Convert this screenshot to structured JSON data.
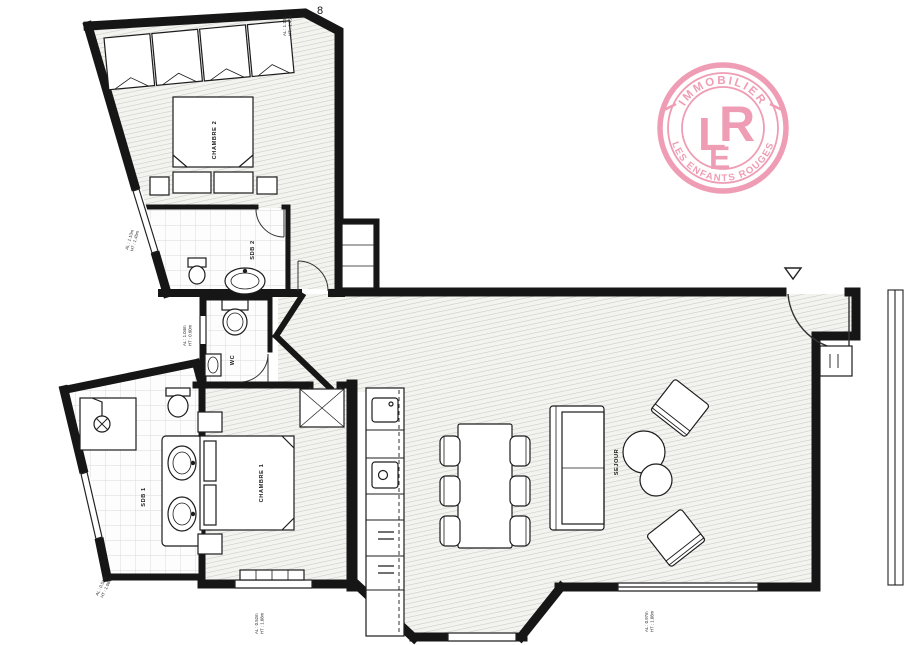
{
  "logo": {
    "arc_top": "IMMOBILIER",
    "arc_bottom": "LES ENFANTS ROUGES",
    "letters": [
      "L",
      "E",
      "R"
    ],
    "color": "#ef9db4"
  },
  "rooms": {
    "bedroom2": "CHAMBRE 2",
    "bathroom2": "SDB 2",
    "wc": "WC",
    "bathroom1": "SDB 1",
    "bedroom1": "CHAMBRE 1",
    "living": "SEJOUR"
  },
  "annotations": {
    "top": [
      "AL : 1.10m",
      "HT : 1.45m"
    ],
    "left_upper": [
      "AL : 1.10m",
      "HT : 1.45m"
    ],
    "left_mid": [
      "AL : 1.04m",
      "HT : 0.60m"
    ],
    "bottom_left": [
      "AL : 0.52m",
      "HT : 1.08m"
    ],
    "bottom_bedroom1": [
      "AL : 0.52m",
      "HT : 1.08m"
    ],
    "bottom_right": [
      "AL : 0.97m",
      "HT : 1.08m"
    ],
    "page_mark": "8"
  },
  "colors": {
    "wall": "#161616",
    "pink": "#ef9db4",
    "hatch_bg": "#f3f3f0",
    "line": "#222222"
  }
}
